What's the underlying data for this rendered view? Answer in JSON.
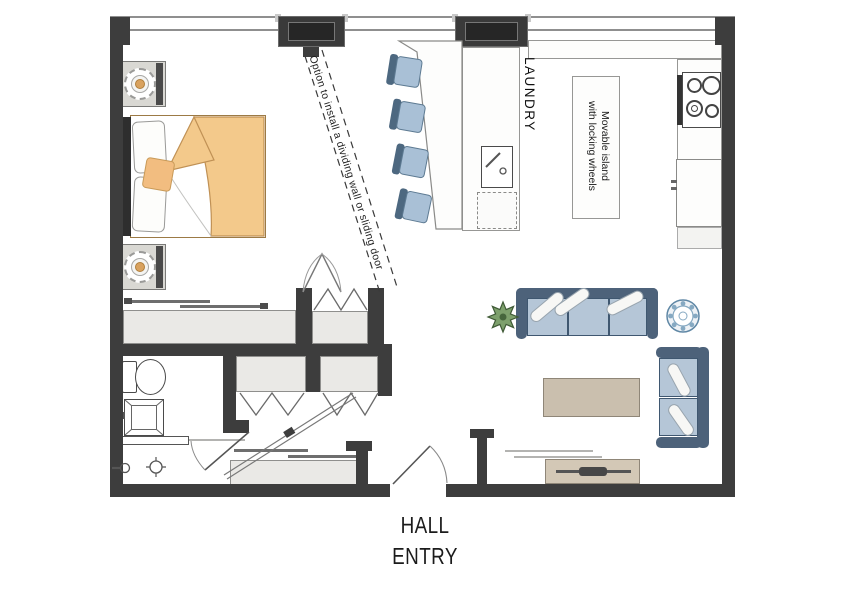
{
  "plan": {
    "type": "studio-apartment-floor-plan",
    "annotations": {
      "divider_note": "Option to install a dividing wall or sliding door",
      "laundry_label": "LAUNDRY",
      "island_label_line1": "Movable island",
      "island_label_line2": "with locking wheels",
      "entry_label_line1": "HALL",
      "entry_label_line2": "ENTRY"
    },
    "colors": {
      "wall": "#3d3d3d",
      "closet_fill": "#eae9e6",
      "bed_blanket": "#f3c98b",
      "accent_pillow": "#f2bd80",
      "lamp_center": "#d9a25f",
      "stool_seat": "#a9c0d6",
      "stool_back": "#4d6880",
      "sofa_frame": "#4d627a",
      "sofa_cushion": "#b5c6d7",
      "coffee_table": "#cabfae",
      "media_console": "#d3c8b6",
      "plant": "#7da06c",
      "side_table": "#86a9c2",
      "counter": "#fdfdfc"
    },
    "furniture": [
      "bed",
      "nightstand",
      "table-lamp",
      "bar-counter",
      "bar-stool",
      "laundry-counter",
      "laundry-sink",
      "kitchen-counter",
      "stove",
      "refrigerator",
      "movable-island",
      "sofa",
      "loveseat",
      "coffee-table",
      "media-console",
      "side-table",
      "plant",
      "toilet",
      "bathroom-sink",
      "bathtub",
      "closet"
    ]
  }
}
